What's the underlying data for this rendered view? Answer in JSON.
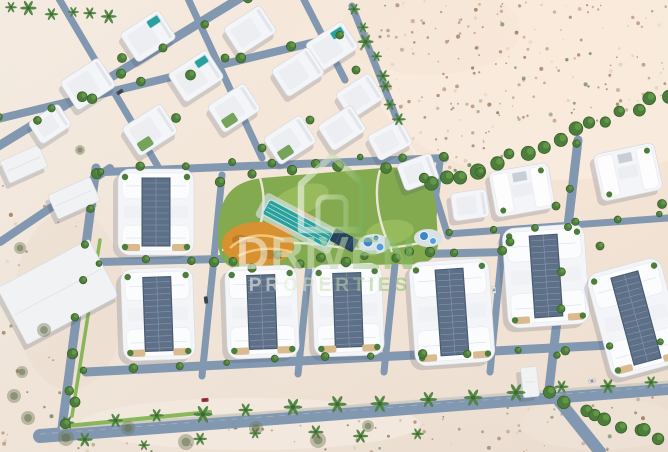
{
  "image": {
    "description": "Aerial 3D masterplan render of a white villa and townhouse community surrounded by desert sand, teal community pool, orange playground, tree-lined streets",
    "width": 668,
    "height": 452
  },
  "watermark": {
    "icon": "house-outline-icon",
    "brand_top": "DRIVEN",
    "brand_bottom": "PROPERTIES",
    "opacity": 0.58,
    "color_white": "rgba(255,255,255,0.95)",
    "color_green": "rgba(118,175,85,0.95)"
  },
  "palette": {
    "sand_light": "#f4ebe1",
    "sand_dark": "#eadcce",
    "sand_glow": "#f6ece2",
    "road": "#8298b1",
    "road_light": "#97a6ba",
    "sidewalk": "#d8d2c6",
    "wall": "#f7f3ec",
    "building": "#f4f5f8",
    "building_edge": "#d7dade",
    "building_inner": "#eceef2",
    "shadow": "rgba(70,80,100,0.20)",
    "solar": "#5d7088",
    "solar_line": "#8798ac",
    "solar_edge": "#46586e",
    "grass": "#84aa50",
    "grass_light": "#9ec061",
    "strip_green": "#7fb14e",
    "tree": "#4c7d3a",
    "tree_dark": "#3a622c",
    "tree_light": "#699a4b",
    "palm": "#4e8340",
    "palm_dark": "#3a6a30",
    "bush": "#6f7a56",
    "pool_teal": "#2ba09d",
    "pool_lane": "#bfe8e6",
    "pool_deck": "#d8e2e6",
    "pool_blue": "#3f86c9",
    "pool_blue2": "#55a0dc",
    "pergola": "#26425c",
    "playground": "#d89130",
    "playground_light": "#f2c476",
    "playground_dark": "#b57722",
    "yard_tan": "#d9bb8e",
    "dot_brown": "#9a6a4c",
    "dot_green": "#56713f",
    "dot_light": "#d9c8b6",
    "path_white": "#f2ede4"
  },
  "scene": {
    "seed": 20240717,
    "desert_regions": [
      {
        "poly": [
          [
            352,
            0
          ],
          [
            668,
            0
          ],
          [
            668,
            96
          ],
          [
            432,
            186
          ],
          [
            398,
            120
          ],
          [
            352,
            40
          ]
        ],
        "n": 230
      },
      {
        "poly": [
          [
            0,
            452
          ],
          [
            0,
            432
          ],
          [
            40,
            436
          ],
          [
            300,
            416
          ],
          [
            668,
            388
          ],
          [
            668,
            452
          ]
        ],
        "n": 90
      },
      {
        "poly": [
          [
            0,
            150
          ],
          [
            92,
            228
          ],
          [
            60,
            428
          ],
          [
            0,
            428
          ]
        ],
        "n": 30
      }
    ],
    "sand_patches": [
      [
        560,
        70,
        190,
        110,
        "#f6ece2",
        0.75
      ],
      [
        430,
        30,
        90,
        45,
        "#f0e2d6",
        0.6
      ],
      [
        250,
        424,
        170,
        26,
        "#f3ebe1",
        0.7
      ],
      [
        70,
        300,
        55,
        90,
        "#eadbcd",
        0.5
      ],
      [
        600,
        424,
        80,
        26,
        "#efe4d8",
        0.6
      ]
    ],
    "walls": [
      {
        "pts": [
          [
            352,
            4
          ],
          [
            398,
            122
          ],
          [
            432,
            186
          ]
        ],
        "w": 1.4,
        "op": 0.9
      },
      {
        "pts": [
          [
            432,
            186
          ],
          [
            668,
            98
          ]
        ],
        "w": 1.4,
        "op": 0.9
      },
      {
        "pts": [
          [
            96,
            168
          ],
          [
            62,
            428
          ]
        ],
        "w": 1.2,
        "op": 0.7
      }
    ],
    "roads": [
      [
        40,
        436,
        668,
        388,
        14
      ],
      [
        552,
        392,
        600,
        452,
        12
      ],
      [
        0,
        242,
        110,
        168,
        8
      ],
      [
        104,
        172,
        445,
        158,
        8
      ],
      [
        100,
        262,
        505,
        252,
        8
      ],
      [
        86,
        372,
        668,
        342,
        9
      ],
      [
        96,
        168,
        62,
        428,
        9
      ],
      [
        214,
        258,
        202,
        376,
        7
      ],
      [
        222,
        175,
        214,
        258,
        7
      ],
      [
        310,
        256,
        298,
        374,
        7
      ],
      [
        396,
        254,
        384,
        372,
        7
      ],
      [
        440,
        162,
        428,
        256,
        7
      ],
      [
        504,
        230,
        490,
        372,
        7
      ],
      [
        578,
        140,
        548,
        398,
        9
      ],
      [
        448,
        234,
        668,
        218,
        7
      ],
      [
        -8,
        150,
        250,
        -8,
        9
      ],
      [
        -6,
        120,
        340,
        36,
        8
      ],
      [
        55,
        -8,
        160,
        170,
        7
      ],
      [
        185,
        -8,
        262,
        158,
        7
      ],
      [
        300,
        -8,
        345,
        80,
        7
      ],
      [
        352,
        6,
        398,
        122,
        7
      ],
      [
        432,
        184,
        448,
        236,
        7
      ]
    ],
    "road_dash": [
      40,
      434,
      668,
      386
    ],
    "sidewalk": [
      60,
      428,
      668,
      382
    ],
    "green_strips": [
      [
        66,
        426,
        210,
        412,
        4
      ],
      [
        100,
        240,
        72,
        416,
        3.5
      ]
    ],
    "amenity": {
      "park_d": "M218,244 C216,196 232,182 262,178 L382,168 C420,165 432,176 436,206 L438,242 C438,262 424,266 398,264 L258,270 C230,272 220,264 218,244 Z",
      "lawns": [
        [
          300,
          200,
          30,
          14,
          -20
        ],
        [
          390,
          232,
          24,
          12,
          -8
        ]
      ],
      "paths": [
        "M222,250 Q280,238 330,246 Q380,254 432,240",
        "M260,178 Q270,210 252,246",
        "M380,170 Q370,205 392,252"
      ],
      "playground": {
        "blobs": [
          [
            258,
            244,
            36,
            22
          ],
          [
            296,
            222,
            18,
            12
          ]
        ],
        "swirls": [
          "M230,248 Q252,228 284,240",
          "M238,256 Q262,244 292,252",
          "M286,218 Q300,212 310,224"
        ],
        "accents": [
          [
            240,
            240,
            8,
            5
          ],
          [
            270,
            254,
            9,
            5
          ]
        ]
      },
      "pool": {
        "cx": 298,
        "cy": 223,
        "rot": 28,
        "x": 262,
        "y": 215,
        "w": 72,
        "h": 17,
        "lanes": 3,
        "deck": [
          256,
          210,
          84,
          27
        ]
      },
      "pergola": {
        "rot": 28,
        "x": 336,
        "y": 228,
        "w": 26,
        "h": 14
      },
      "splash": [
        {
          "cx": 374,
          "cy": 244,
          "rx": 16,
          "ry": 10,
          "drops": [
            [
              368,
              242,
              5
            ],
            [
              380,
              247,
              4
            ],
            [
              376,
              238,
              3
            ]
          ]
        },
        {
          "cx": 428,
          "cy": 238,
          "rx": 14,
          "ry": 9,
          "drops": [
            [
              424,
              236,
              4.5
            ],
            [
              433,
              241,
              3.5
            ]
          ]
        }
      ],
      "trees": [
        [
          220,
          182
        ],
        [
          252,
          174
        ],
        [
          292,
          170
        ],
        [
          338,
          166
        ],
        [
          386,
          168
        ],
        [
          424,
          178
        ],
        [
          214,
          262
        ],
        [
          252,
          268
        ],
        [
          300,
          264
        ],
        [
          346,
          262
        ],
        [
          396,
          258
        ],
        [
          430,
          252
        ]
      ]
    },
    "villas": [
      [
        148,
        36,
        -33,
        46,
        34,
        "p"
      ],
      [
        250,
        30,
        -33,
        44,
        32,
        ""
      ],
      [
        332,
        46,
        -33,
        44,
        32,
        "p"
      ],
      [
        88,
        84,
        -33,
        46,
        34,
        ""
      ],
      [
        196,
        76,
        -33,
        46,
        34,
        "p"
      ],
      [
        298,
        72,
        -33,
        44,
        32,
        ""
      ],
      [
        360,
        96,
        -33,
        40,
        30,
        ""
      ],
      [
        50,
        124,
        -33,
        36,
        26,
        ""
      ],
      [
        150,
        130,
        -33,
        46,
        34,
        "g"
      ],
      [
        234,
        108,
        -33,
        44,
        32,
        "g"
      ],
      [
        290,
        140,
        -33,
        44,
        32,
        "g"
      ],
      [
        342,
        128,
        -33,
        40,
        30,
        ""
      ],
      [
        390,
        140,
        -28,
        38,
        28,
        ""
      ],
      [
        418,
        172,
        -20,
        36,
        28,
        ""
      ],
      [
        470,
        205,
        -8,
        36,
        28,
        ""
      ]
    ],
    "hvillas": [
      [
        522,
        190,
        -10,
        60,
        46
      ],
      [
        628,
        172,
        -12,
        62,
        48
      ]
    ],
    "townhouses_portrait": [
      [
        156,
        212,
        0,
        76,
        86
      ],
      [
        158,
        314,
        -2,
        72,
        92
      ],
      [
        262,
        312,
        -2,
        72,
        92
      ],
      [
        348,
        310,
        -2,
        70,
        92
      ],
      [
        452,
        312,
        -4,
        80,
        104
      ],
      [
        546,
        276,
        -4,
        82,
        100
      ],
      [
        636,
        318,
        -15,
        76,
        108
      ]
    ],
    "neighbors": [
      {
        "type": "warehouse",
        "x": 58,
        "y": 292,
        "rot": -28,
        "w": 104,
        "h": 64
      },
      {
        "type": "shed",
        "x": 24,
        "y": 164,
        "rot": -24,
        "w": 42,
        "h": 24
      },
      {
        "type": "shed",
        "x": 74,
        "y": 198,
        "rot": -24,
        "w": 46,
        "h": 26
      },
      {
        "type": "cabin",
        "x": 530,
        "y": 382,
        "rot": -6,
        "w": 16,
        "h": 30
      }
    ],
    "tree_rows": [
      {
        "from": [
          68,
          424
        ],
        "to": [
          650,
          382
        ],
        "n": 14,
        "type": "palm",
        "s": 7,
        "j": 3
      },
      {
        "from": [
          90,
          444
        ],
        "to": [
          420,
          428
        ],
        "n": 7,
        "type": "palm",
        "s": 6,
        "j": 6
      },
      {
        "from": [
          432,
          186
        ],
        "to": [
          668,
          96
        ],
        "n": 16,
        "type": "tree",
        "r": 6,
        "j": 4
      },
      {
        "from": [
          354,
          8
        ],
        "to": [
          398,
          120
        ],
        "n": 8,
        "type": "palm",
        "s": 6,
        "j": 4
      },
      {
        "from": [
          94,
          172
        ],
        "to": [
          64,
          424
        ],
        "n": 8,
        "type": "tree",
        "r": 4,
        "j": 3
      },
      {
        "from": [
          100,
          170
        ],
        "to": [
          445,
          156
        ],
        "n": 9,
        "type": "tree",
        "r": 3.5,
        "j": 3
      },
      {
        "from": [
          100,
          262
        ],
        "to": [
          500,
          252
        ],
        "n": 10,
        "type": "tree",
        "r": 3.5,
        "j": 3
      },
      {
        "from": [
          86,
          370
        ],
        "to": [
          660,
          344
        ],
        "n": 13,
        "type": "tree",
        "r": 3.5,
        "j": 3
      },
      {
        "from": [
          -4,
          148
        ],
        "to": [
          246,
          -4
        ],
        "n": 7,
        "type": "tree",
        "r": 4,
        "j": 4
      },
      {
        "from": [
          0,
          118
        ],
        "to": [
          336,
          38
        ],
        "n": 8,
        "type": "tree",
        "r": 4,
        "j": 4
      },
      {
        "from": [
          575,
          145
        ],
        "to": [
          550,
          395
        ],
        "n": 7,
        "type": "tree",
        "r": 4,
        "j": 3
      },
      {
        "from": [
          450,
          232
        ],
        "to": [
          660,
          216
        ],
        "n": 6,
        "type": "tree",
        "r": 3.5,
        "j": 3
      },
      {
        "from": [
          556,
          396
        ],
        "to": [
          660,
          442
        ],
        "n": 9,
        "type": "tree",
        "r": 5,
        "j": 8
      },
      {
        "from": [
          8,
          8
        ],
        "to": [
          112,
          14
        ],
        "n": 6,
        "type": "palm",
        "s": 6,
        "j": 4
      }
    ],
    "trees": [
      [
        122,
        58,
        4.5,
        "tree"
      ],
      [
        176,
        118,
        4.5,
        "tree"
      ],
      [
        262,
        148,
        4,
        "tree"
      ],
      [
        225,
        58,
        4,
        "tree"
      ],
      [
        310,
        120,
        4,
        "tree"
      ],
      [
        356,
        70,
        4,
        "tree"
      ],
      [
        480,
        172,
        4.5,
        "tree"
      ],
      [
        556,
        206,
        4,
        "tree"
      ],
      [
        600,
        246,
        4,
        "tree"
      ],
      [
        662,
        204,
        4.5,
        "tree"
      ],
      [
        510,
        242,
        4,
        "tree"
      ],
      [
        20,
        248,
        6,
        "bush"
      ],
      [
        44,
        330,
        7,
        "bush"
      ],
      [
        22,
        372,
        6,
        "bush"
      ],
      [
        80,
        150,
        5,
        "bush"
      ],
      [
        28,
        418,
        7,
        "bush"
      ],
      [
        66,
        438,
        8,
        "bush"
      ],
      [
        128,
        428,
        7,
        "bush"
      ],
      [
        186,
        442,
        8,
        "bush"
      ],
      [
        256,
        428,
        7,
        "bush"
      ],
      [
        318,
        440,
        8,
        "bush"
      ],
      [
        368,
        426,
        6,
        "bush"
      ],
      [
        14,
        396,
        7,
        "bush"
      ],
      [
        75,
        402,
        5,
        "tree"
      ]
    ],
    "cars": [
      [
        205,
        400,
        -5,
        "#a8323a"
      ],
      [
        206,
        300,
        83,
        "#3c4654"
      ],
      [
        494,
        290,
        84,
        "#eef1f4"
      ],
      [
        592,
        381,
        -12,
        "#dfe3e8"
      ],
      [
        120,
        92,
        -33,
        "#434c5a"
      ]
    ]
  }
}
